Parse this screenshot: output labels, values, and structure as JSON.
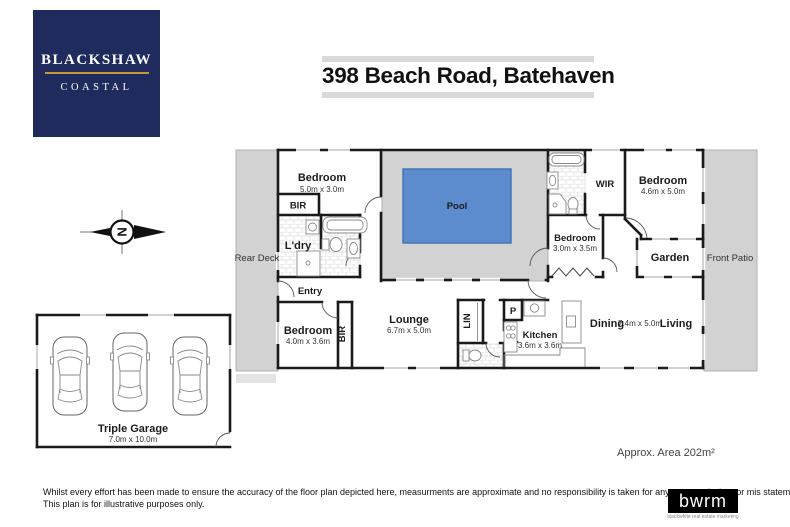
{
  "header": {
    "logo_line1": "BLACKSHAW",
    "logo_line2": "COASTAL",
    "title": "398 Beach Road, Batehaven"
  },
  "plan": {
    "labels": {
      "bedroom1": {
        "name": "Bedroom",
        "dims": "5.0m x 3.0m"
      },
      "bir1": {
        "name": "BIR"
      },
      "ldry": {
        "name": "L'dry"
      },
      "pool": {
        "name": "Pool"
      },
      "rear_deck": {
        "name": "Rear Deck"
      },
      "entry": {
        "name": "Entry"
      },
      "bedroom2": {
        "name": "Bedroom",
        "dims": "4.0m x 3.6m"
      },
      "bir2": {
        "name": "BIR"
      },
      "lounge": {
        "name": "Lounge",
        "dims": "6.7m x 5.0m"
      },
      "lin": {
        "name": "LIN"
      },
      "pantry": {
        "name": "P"
      },
      "kitchen": {
        "name": "Kitchen",
        "dims": "3.6m x 3.6m"
      },
      "dining": {
        "name": "Dining"
      },
      "dining_living_dims": "7.4m x 5.0m",
      "living": {
        "name": "Living"
      },
      "bedroom3": {
        "name": "Bedroom",
        "dims": "3.0m x 3.5m"
      },
      "wir": {
        "name": "WIR"
      },
      "bedroom4": {
        "name": "Bedroom",
        "dims": "4.6m x 5.0m"
      },
      "garden": {
        "name": "Garden"
      },
      "front_patio": {
        "name": "Front Patio"
      },
      "garage": {
        "name": "Triple Garage",
        "dims": "7.0m x 10.0m"
      }
    },
    "compass_n": "N",
    "area_note": "Approx. Area 202m²"
  },
  "footer": {
    "disclaimer_line1": "Whilst every effort has been made to ensure the accuracy of the floor plan depicted here, measurments are approximate and no responsibility is taken for any error, omission, or mis statement.",
    "disclaimer_line2": "This plan is for illustrative purposes only.",
    "brand_name": "bwrm",
    "brand_tagline": "blackwhite real estate marketing"
  },
  "colors": {
    "navy": "#1e2b5c",
    "gold": "#c8963c",
    "pool_blue": "#5c8ccd",
    "deck_gray": "#d2d2d2",
    "wall": "#1a1a1a"
  }
}
